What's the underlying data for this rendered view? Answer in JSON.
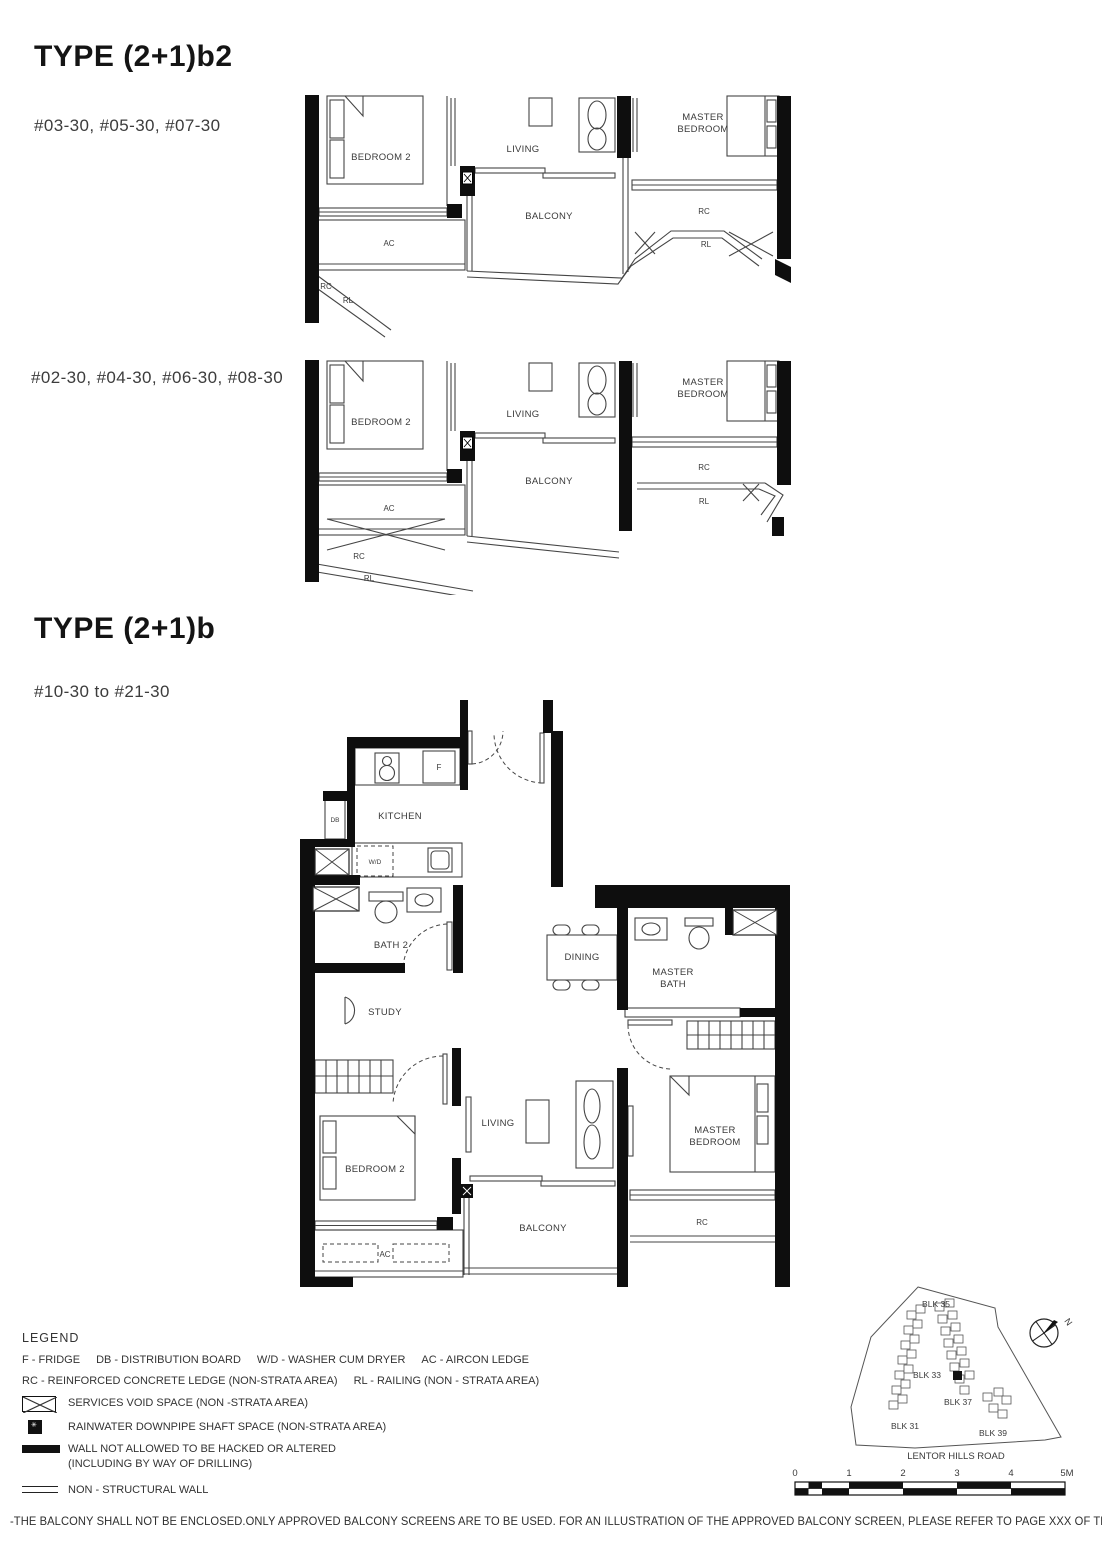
{
  "titles": {
    "b2": "TYPE (2+1)b2",
    "b": "TYPE (2+1)b"
  },
  "units": {
    "b2_upper": "#03-30, #05-30, #07-30",
    "b2_lower": "#02-30, #04-30, #06-30, #08-30",
    "b": "#10-30 to #21-30"
  },
  "rooms": {
    "bedroom2": "BEDROOM 2",
    "living": "LIVING",
    "master": "MASTER",
    "bedroom": "BEDROOM",
    "bath": "BATH",
    "balcony": "BALCONY",
    "kitchen": "KITCHEN",
    "bath2": "BATH 2",
    "study": "STUDY",
    "dining": "DINING"
  },
  "tags": {
    "ac": "AC",
    "rc": "RC",
    "rl": "RL",
    "db": "DB",
    "wd": "W/D",
    "f": "F"
  },
  "legend": {
    "heading": "LEGEND",
    "items1": [
      "F - FRIDGE",
      "DB - DISTRIBUTION BOARD",
      "W/D - WASHER CUM DRYER",
      "AC - AIRCON LEDGE"
    ],
    "items2": [
      "RC - REINFORCED CONCRETE LEDGE (NON-STRATA AREA)",
      "RL - RAILING (NON - STRATA AREA)"
    ],
    "services_void": "SERVICES VOID SPACE (NON -STRATA AREA)",
    "rainwater": "RAINWATER DOWNPIPE SHAFT SPACE (NON-STRATA AREA)",
    "wall1": "WALL NOT ALLOWED TO BE HACKED OR ALTERED",
    "wall2": "(INCLUDING BY WAY OF DRILLING)",
    "nonstructural": "NON - STRUCTURAL WALL"
  },
  "site": {
    "blk31": "BLK 31",
    "blk33": "BLK 33",
    "blk35": "BLK 35",
    "blk37": "BLK 37",
    "blk39": "BLK 39",
    "road": "LENTOR HILLS ROAD",
    "north": "N"
  },
  "scale": {
    "ticks": [
      "0",
      "1",
      "2",
      "3",
      "4",
      "5M"
    ]
  },
  "footnote": "-THE BALCONY SHALL NOT BE ENCLOSED.ONLY APPROVED BALCONY SCREENS ARE TO BE USED. FOR AN ILLUSTRATION OF THE APPROVED BALCONY SCREEN, PLEASE REFER TO PAGE XXX OF THIS BROCHURE."
}
